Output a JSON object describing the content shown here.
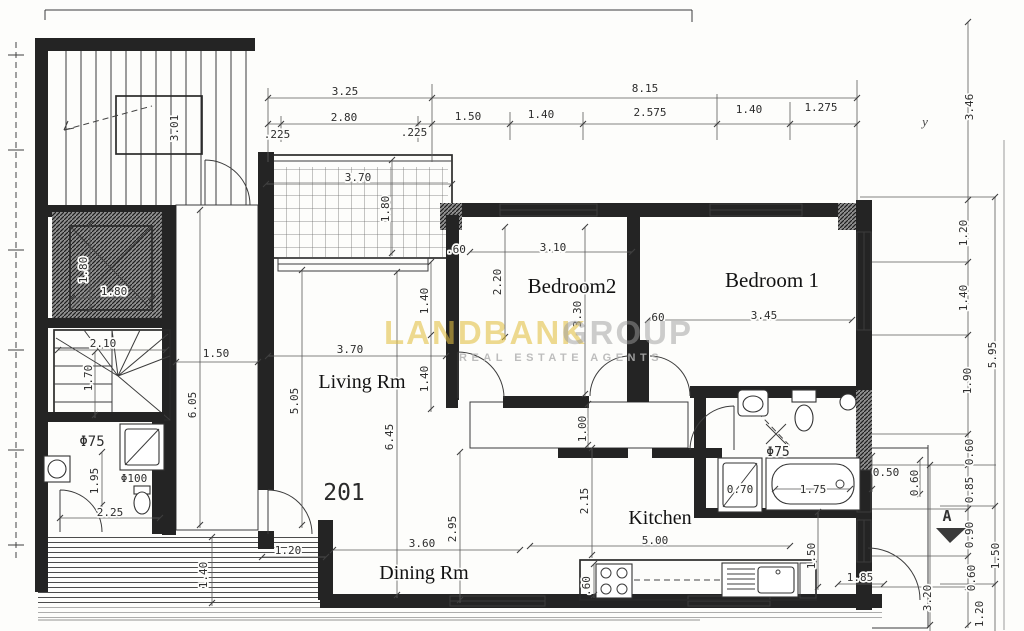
{
  "unit": {
    "number": "201"
  },
  "rooms": {
    "living": "Living Rm",
    "bedroom2": "Bedroom2",
    "bedroom1": "Bedroom 1",
    "kitchen": "Kitchen",
    "dining": "Dining Rm"
  },
  "watermark": {
    "brand_primary": "LANDBANK",
    "brand_secondary": "GROUP",
    "tagline": "REAL ESTATE AGENTS",
    "primary_color": "#e3c042",
    "secondary_color": "#9d9d9d",
    "tagline_color": "#b3b3b3"
  },
  "markers": {
    "section": "A",
    "axis": "y"
  },
  "dims": {
    "top": {
      "total_left": "3.25",
      "total_right": "8.15",
      "wall_left": ".225",
      "opening": "2.80",
      "wall_right": ".225",
      "seg_150": "1.50",
      "seg_140a": "1.40",
      "seg_2575": "2.575",
      "seg_140b": "1.40",
      "seg_1275": "1.275"
    },
    "right": {
      "v346": "3.46",
      "v120": "1.20",
      "v140": "1.40",
      "v190": "1.90",
      "v595": "5.95",
      "v060a": "0.60",
      "v085": "0.85",
      "v090": "0.90",
      "v060b": "0.60",
      "v150": "1.50",
      "v320": "3.20",
      "v060c": "0.60",
      "v050": "0.50",
      "v120b": "1.20"
    },
    "core": {
      "stair_well": "3.01",
      "elev_h": "1.80",
      "elev_w": "1.80",
      "winder_w": "2.10",
      "winder_h": "1.70",
      "corridor_w": "1.50",
      "corridor_len": "6.05",
      "drain_small": "Φ75",
      "drain_large": "Φ100",
      "bath_h": "1.95",
      "bath_w": "2.25",
      "walk_h": "1.40",
      "walk_w": "1.20"
    },
    "balcony": {
      "w": "3.70",
      "d": "1.80"
    },
    "living": {
      "w": "3.70",
      "h_left": "5.05",
      "h_mid": "6.45",
      "seg_140a": "1.40",
      "seg_140b": "1.40"
    },
    "bed2": {
      "w": "3.10",
      "h_left": "2.20",
      "h_mid": "3.30",
      "w060a": ".60",
      "w060b": "60"
    },
    "bed1": {
      "w": "3.45"
    },
    "hall": {
      "w": "1.00"
    },
    "bath": {
      "drain": "Φ75",
      "shower_w": "0.70",
      "tub_l": "1.75"
    },
    "kitchen": {
      "w": "5.00",
      "h": "2.15",
      "counter_d": ".60",
      "seg_150": "1.50",
      "seg_185": "1.85"
    },
    "dining": {
      "w": "3.60",
      "h": "2.95"
    }
  }
}
